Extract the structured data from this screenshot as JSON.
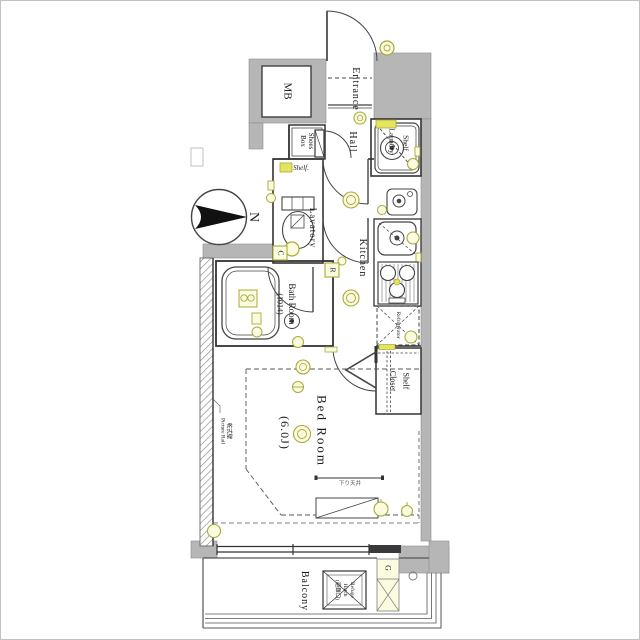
{
  "title": "apartment-floor-plan",
  "colors": {
    "wall_gray": "#b6b6b6",
    "wall_edge": "#8c8c8c",
    "line_dark": "#333333",
    "symbol_olive": "#a8a83a",
    "symbol_fill": "#fbfbe0",
    "highlight_yellow": "#e4e45e"
  },
  "labels": {
    "mb": "MB",
    "entrance": "Entrance",
    "hall": "Hall",
    "shoes1": "Shoes",
    "shoes2": "Box",
    "laundry_shelf": "Shelf",
    "laundry": "Laundry",
    "lav_shelf": "Shelf.",
    "lavatory": "Lavatory",
    "kitchen": "Kitchen",
    "bath1": "Bath Room",
    "bath2": "(1014)",
    "refrigerator": "Refrigerator",
    "closet_shelf": "Shelf",
    "closet": "Closet",
    "bed1": "Bed Room",
    "bed2": "(6.0J)",
    "balcony": "Balcony",
    "refuge1": "Refuge",
    "refuge2": "Hatch",
    "refuge3": "(避難口)",
    "gas_meter": "G",
    "remote_box": "R",
    "control_box": "C",
    "north": "N",
    "wall_note": "乾式壁\nPicture Rail",
    "ceiling_note": "下り天井"
  }
}
